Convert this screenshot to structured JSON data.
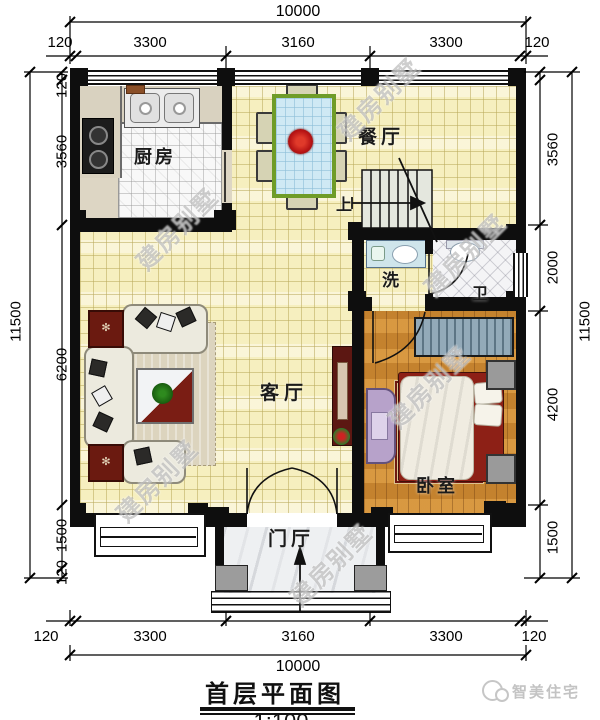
{
  "title": {
    "name": "首层平面图",
    "scale": "1:100"
  },
  "brand": {
    "logo_text": "智美住宅"
  },
  "watermark_text": "建房别墅",
  "rooms": {
    "kitchen": "厨房",
    "dining": "餐厅",
    "living": "客厅",
    "bedroom": "卧室",
    "wash": "洗",
    "bath": "卫",
    "foyer": "门厅"
  },
  "stairs": {
    "direction_label": "上"
  },
  "dimensions": {
    "top": {
      "overall": "10000",
      "segments": [
        "120",
        "3300",
        "3160",
        "3300",
        "120"
      ]
    },
    "bottom": {
      "overall": "10000",
      "segments": [
        "120",
        "3300",
        "3160",
        "3300",
        "120"
      ]
    },
    "left": {
      "overall": "11500",
      "segments": [
        "120",
        "3560",
        "6200",
        "1500",
        "120"
      ]
    },
    "right": {
      "overall": "11500",
      "segments": [
        "3560",
        "2000",
        "4200",
        "1500"
      ]
    }
  }
}
